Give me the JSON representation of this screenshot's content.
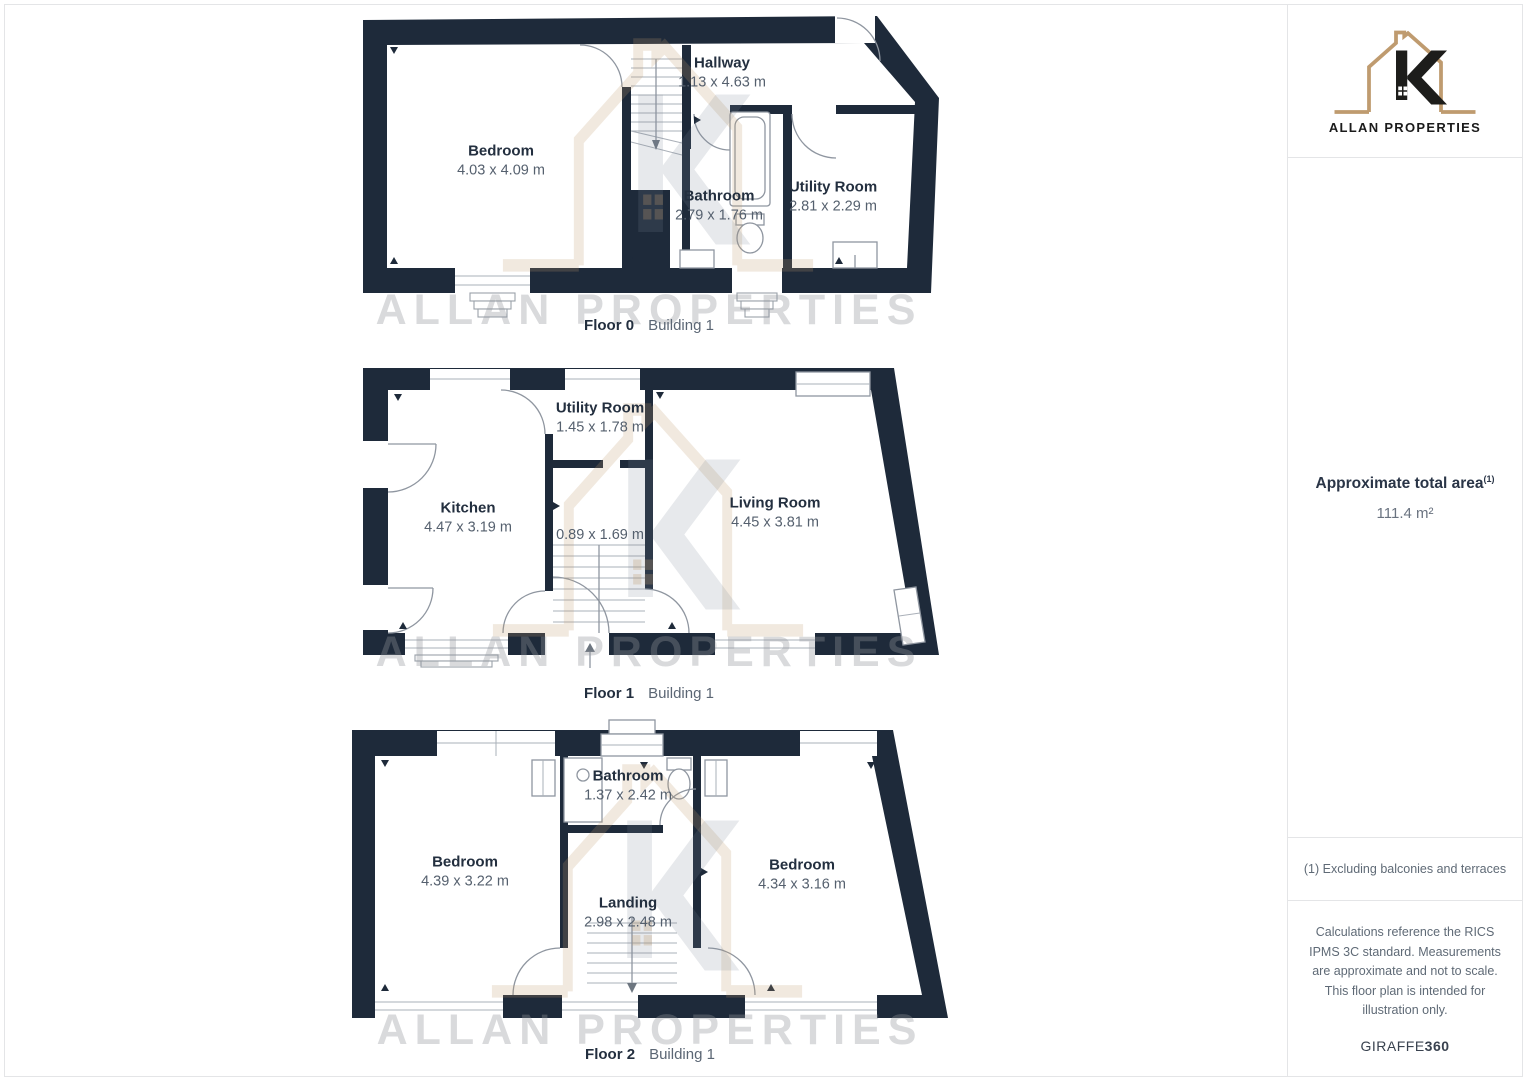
{
  "branding": {
    "name": "ALLAN PROPERTIES"
  },
  "colors": {
    "wall": "#1e2a3a",
    "logo_house": "#bf9b6f",
    "logo_letter": "#1d1d1b",
    "room_name_text": "#232f3f",
    "room_dims_text": "#55606e"
  },
  "watermark": {
    "text": "ALLAN PROPERTIES"
  },
  "sidebar": {
    "total_area_label": "Approximate total area",
    "total_area_sup": "(1)",
    "total_area_value": "111.4 m²",
    "footnote": "(1) Excluding balconies and terraces",
    "disclaimer": "Calculations reference the RICS IPMS 3C standard. Measurements are approximate and not to scale. This floor plan is intended for illustration only.",
    "provider": "GIRAFFE",
    "provider_suffix": "360"
  },
  "floors": [
    {
      "label": "Floor 0",
      "building": "Building 1",
      "rooms": [
        {
          "name": "Bedroom",
          "dims": "4.03 x 4.09 m"
        },
        {
          "name": "Hallway",
          "dims": "1.13 x 4.63 m"
        },
        {
          "name": "Bathroom",
          "dims": "2.79 x 1.76 m"
        },
        {
          "name": "Utility Room",
          "dims": "2.81 x 2.29 m"
        }
      ]
    },
    {
      "label": "Floor 1",
      "building": "Building 1",
      "rooms": [
        {
          "name": "Kitchen",
          "dims": "4.47 x 3.19 m"
        },
        {
          "name": "Utility Room",
          "dims": "1.45 x 1.78 m"
        },
        {
          "name": "",
          "dims": "0.89 x 1.69 m"
        },
        {
          "name": "Living Room",
          "dims": "4.45 x 3.81 m"
        }
      ]
    },
    {
      "label": "Floor 2",
      "building": "Building 1",
      "rooms": [
        {
          "name": "Bedroom",
          "dims": "4.39 x 3.22 m"
        },
        {
          "name": "Bathroom",
          "dims": "1.37 x 2.42 m"
        },
        {
          "name": "Landing",
          "dims": "2.98 x 2.48 m"
        },
        {
          "name": "Bedroom",
          "dims": "4.34 x 3.16 m"
        }
      ]
    }
  ]
}
